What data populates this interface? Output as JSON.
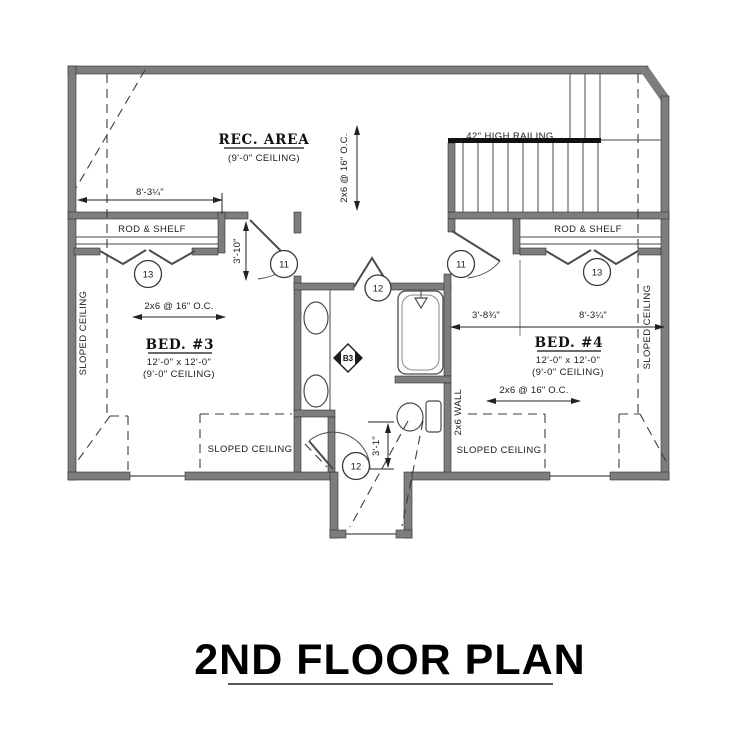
{
  "title": {
    "text": "2ND FLOOR PLAN"
  },
  "rooms": {
    "rec": {
      "name": "REC. AREA",
      "ceiling": "(9'-0\" CEILING)"
    },
    "bed3": {
      "name": "BED. #3",
      "size": "12'-0\" x 12'-0\"",
      "ceiling": "(9'-0\" CEILING)"
    },
    "bed4": {
      "name": "BED. #4",
      "size": "12'-0\" x 12'-0\"",
      "ceiling": "(9'-0\" CEILING)"
    }
  },
  "labels": {
    "railing": "42\" HIGH RAILING",
    "rod_shelf": "ROD & SHELF",
    "sloped_ceiling": "SLOPED CEILING",
    "framing": "2x6 @ 16\" O.C.",
    "wall_2x6": "2x6 WALL"
  },
  "dimensions": {
    "closet_width": "8'-3¼\"",
    "hall_width": "3'-10\"",
    "bed4_left": "3'-8¾\"",
    "bed4_right": "8'-3¼\"",
    "nook_depth": "3'-1\""
  },
  "tags": {
    "door11": "11",
    "door12": "12",
    "door13": "13",
    "b3": "B3"
  },
  "colors": {
    "wall_fill": "#7d7d7d",
    "line": "#3a3a3a",
    "text": "#1b1b1b",
    "railing": "#111111"
  }
}
